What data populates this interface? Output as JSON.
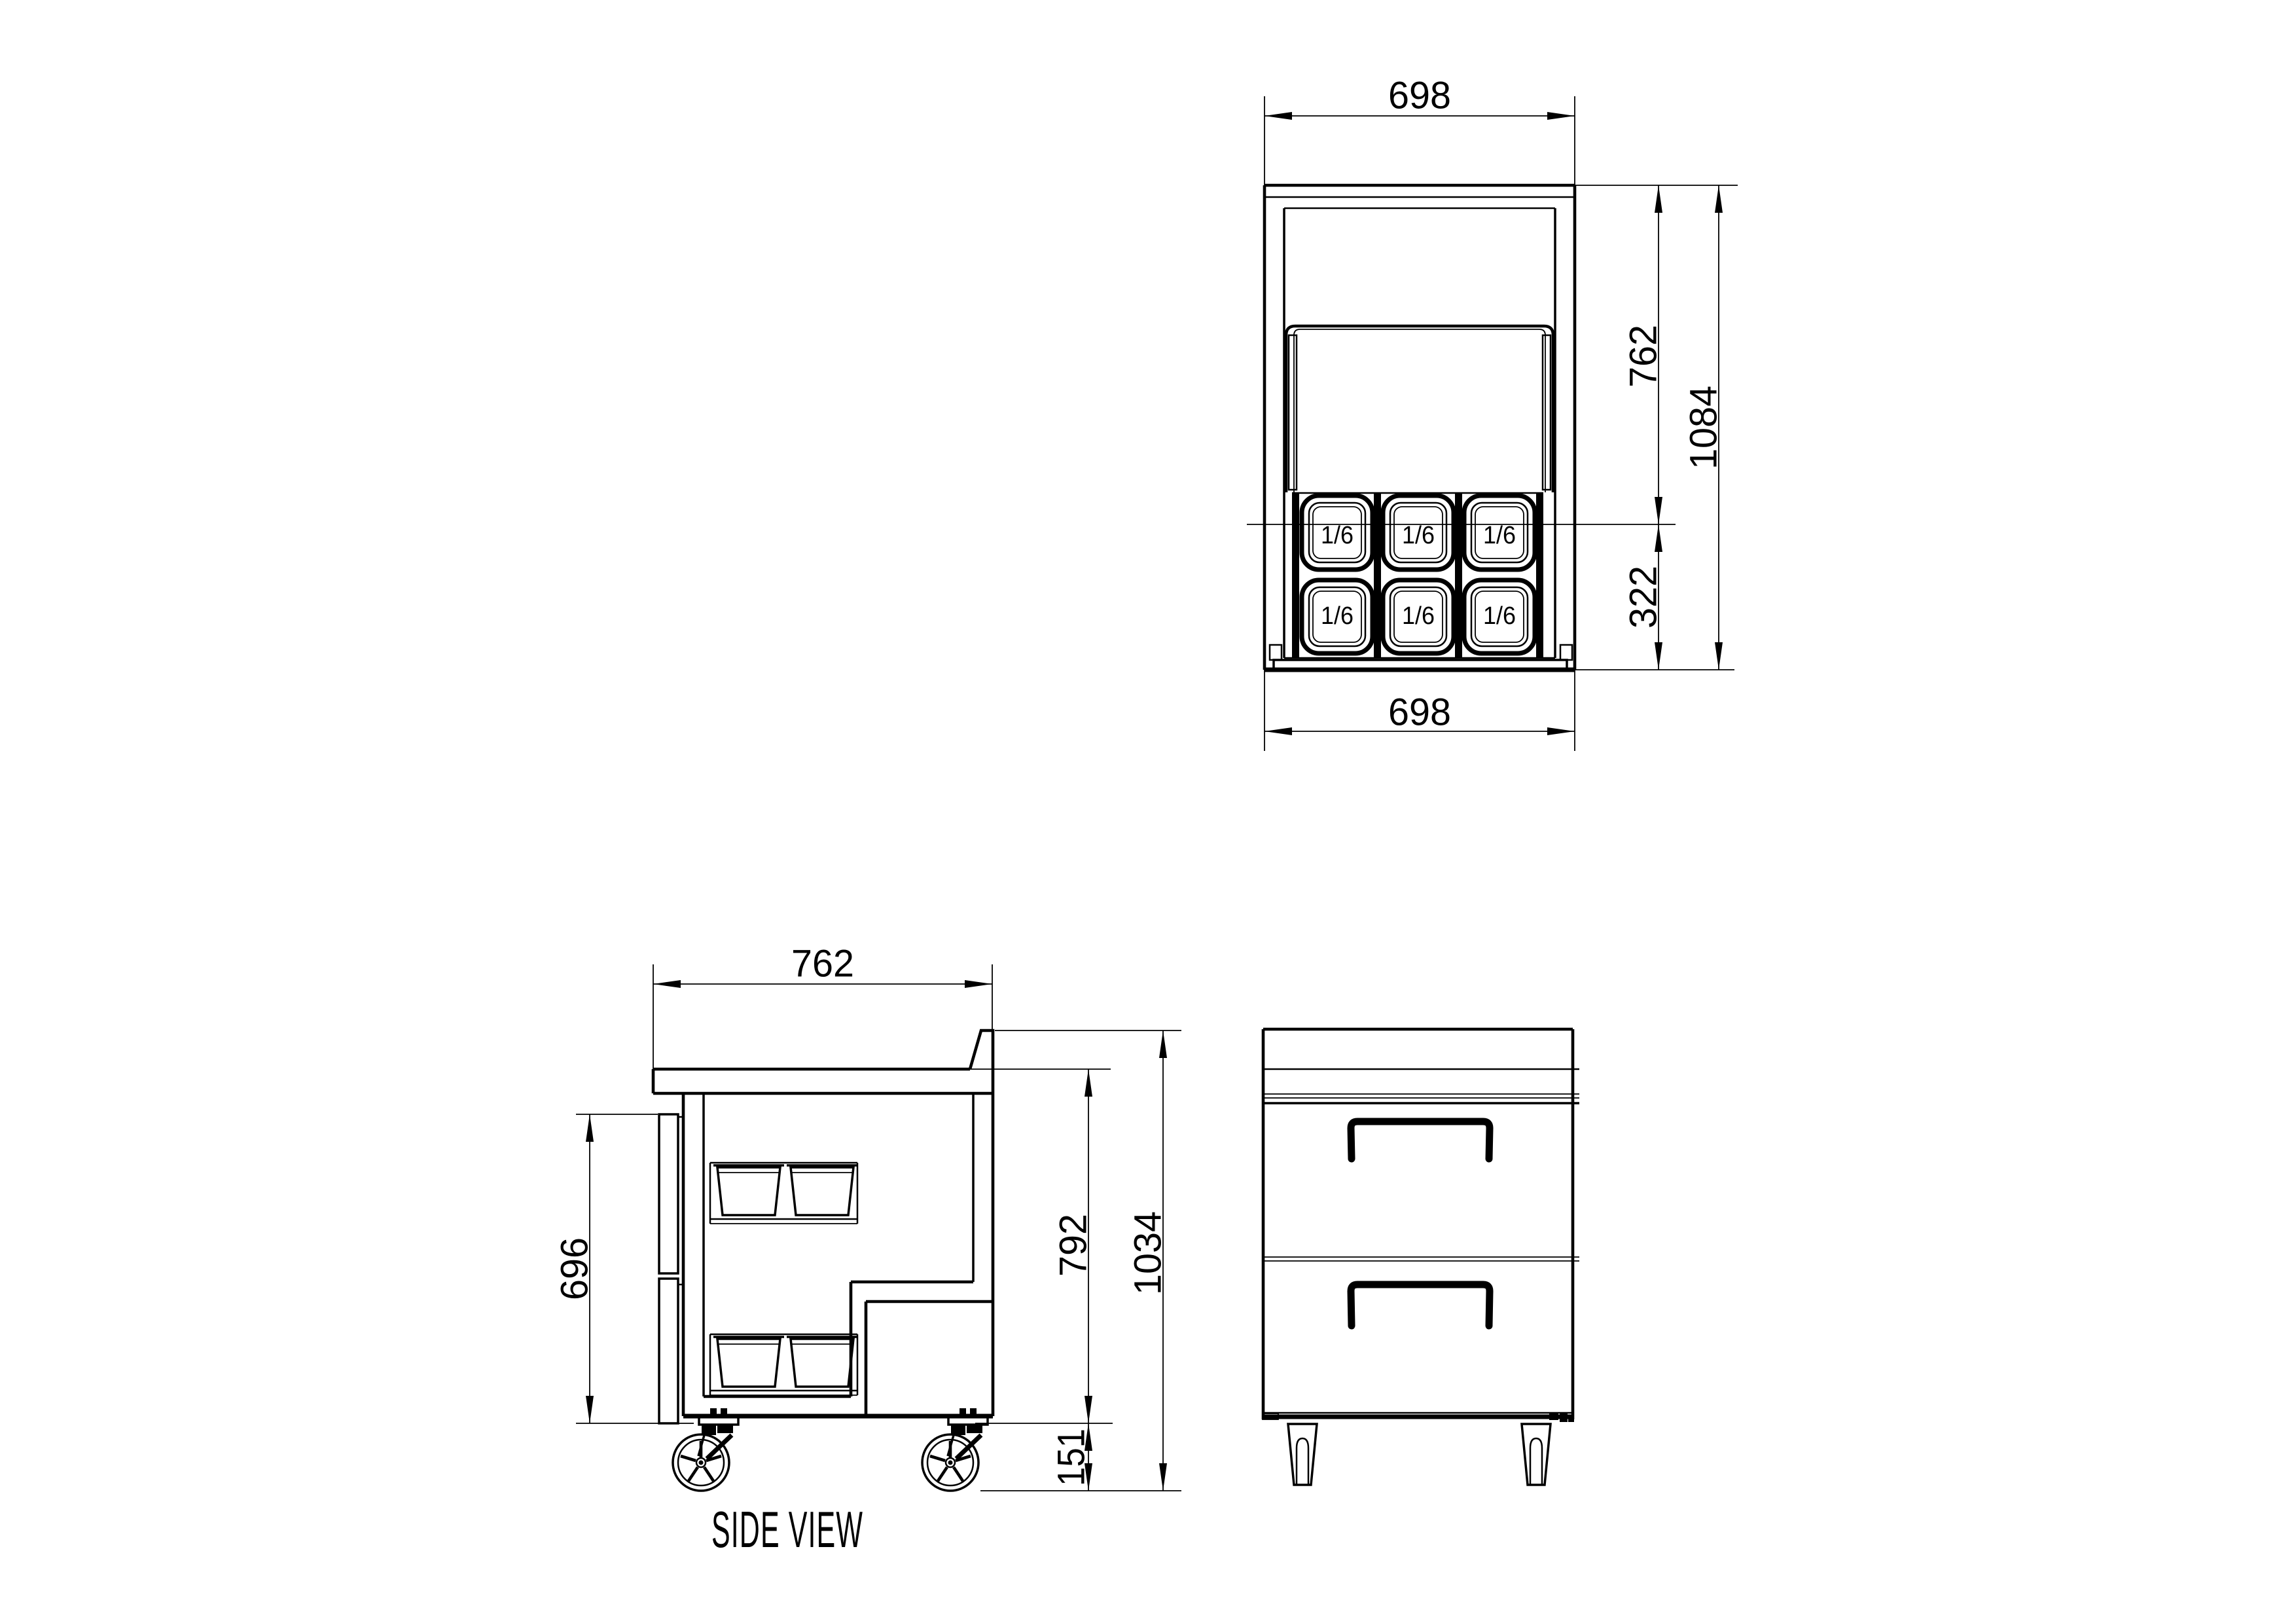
{
  "page": {
    "background": "#ffffff",
    "line_color": "#000000"
  },
  "plan_view": {
    "dim_width_top": "698",
    "dim_width_bottom": "698",
    "dim_depth_upper": "762",
    "dim_depth_lower": "322",
    "dim_depth_total": "1084",
    "pans": [
      "1/6",
      "1/6",
      "1/6",
      "1/6",
      "1/6",
      "1/6"
    ]
  },
  "side_view": {
    "title": "SIDE VIEW",
    "dim_depth": "762",
    "dim_front_height": "696",
    "dim_body_height": "792",
    "dim_overall_height": "1034",
    "dim_caster_height": "151"
  }
}
